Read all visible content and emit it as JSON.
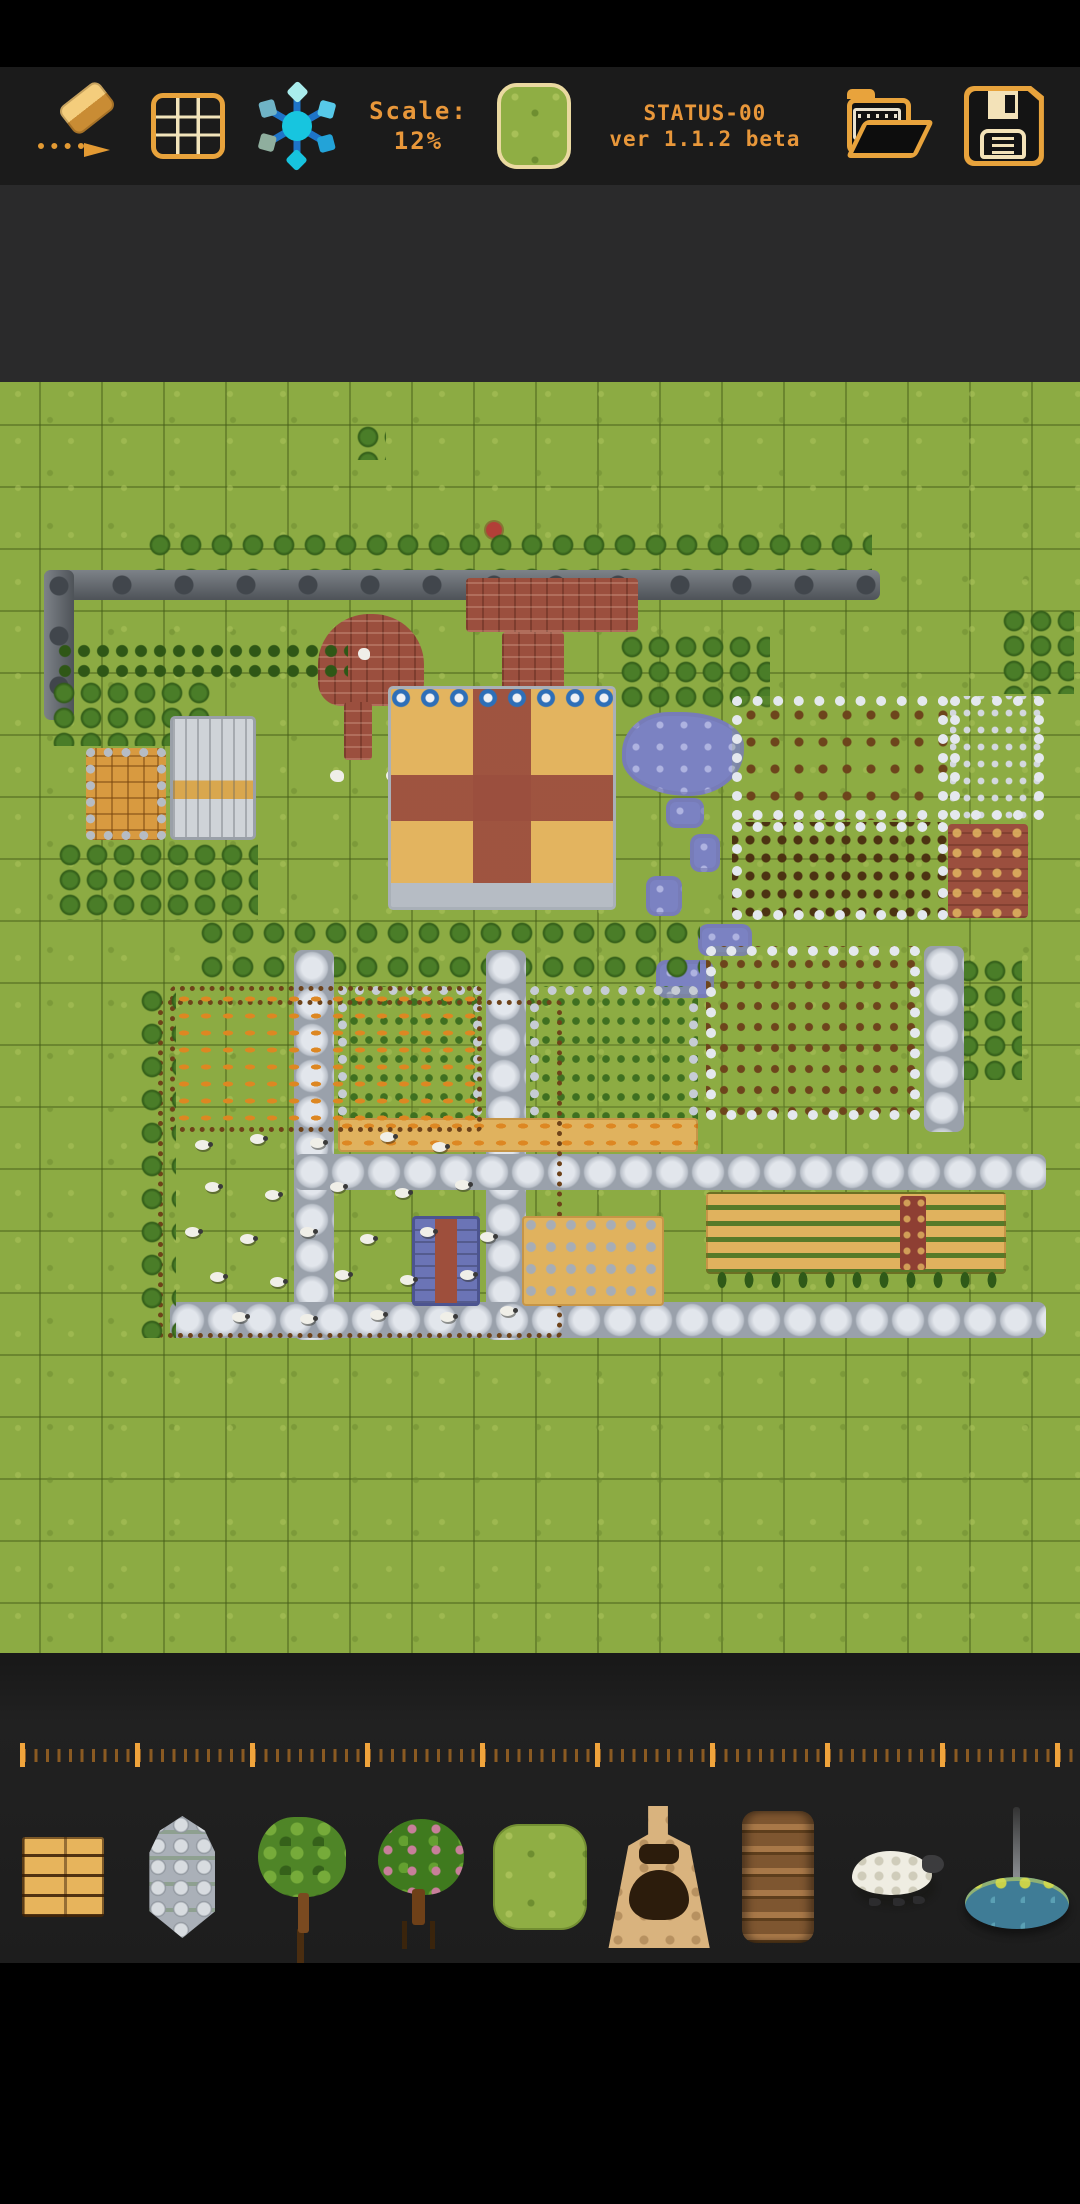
{
  "app": {
    "status_line": "STATUS-00",
    "version_line": "ver 1.1.2 beta",
    "scale_label": "Scale:",
    "scale_value": "12%"
  },
  "colors": {
    "accent_orange": "#e8a33c",
    "text_orange": "#e8973a",
    "toolbar_bg": "#1b1b1b",
    "workspace_bg": "#2a2a2b",
    "grass": "#8cab43",
    "stone_path": "#c9cdd5",
    "brick": "#9b4f3e",
    "pond": "#7b82c2",
    "sand": "#e0b25e"
  },
  "toolbar": {
    "icons": [
      "eraser-icon",
      "grid-icon",
      "snowflake-icon",
      "current-tile-grass",
      "open-folder-icon",
      "save-icon"
    ]
  },
  "ruler": {
    "minor_tick_spacing_px": 11.5,
    "minor_per_major": 10,
    "tick_color_major": "#f0a43c",
    "tick_color_minor": "#8a5a22"
  },
  "palette": {
    "items": [
      {
        "id": "wood",
        "label": "wood-planks-tile"
      },
      {
        "id": "stone",
        "label": "stone-pillar-tile"
      },
      {
        "id": "tree",
        "label": "tree-tile"
      },
      {
        "id": "fruit",
        "label": "fruit-tree-tile"
      },
      {
        "id": "grass",
        "label": "grass-tile",
        "selected": true
      },
      {
        "id": "kiln",
        "label": "kiln-tile"
      },
      {
        "id": "barrels",
        "label": "barrel-stack-tile"
      },
      {
        "id": "sheep",
        "label": "sheep-tile"
      },
      {
        "id": "fountain",
        "label": "fountain-tile"
      }
    ]
  },
  "map": {
    "cell_px": 62,
    "features": [
      {
        "name": "lone-tree",
        "type": "tree-cluster",
        "x": 356,
        "y": 44,
        "w": 30,
        "h": 34
      },
      {
        "name": "red-flower",
        "type": "flower",
        "x": 486,
        "y": 140,
        "w": 16,
        "h": 16
      },
      {
        "name": "wall-tree-row",
        "type": "tree-row",
        "x": 148,
        "y": 152,
        "w": 724,
        "h": 36
      },
      {
        "name": "north-wall",
        "type": "wall",
        "x": 44,
        "y": 188,
        "w": 836,
        "h": 30
      },
      {
        "name": "west-wall",
        "type": "wall-v",
        "x": 44,
        "y": 188,
        "w": 30,
        "h": 150
      },
      {
        "name": "brick-gate",
        "type": "brick",
        "x": 466,
        "y": 196,
        "w": 172,
        "h": 54
      },
      {
        "name": "brick-chimney-path",
        "type": "brick",
        "x": 502,
        "y": 250,
        "w": 62,
        "h": 278
      },
      {
        "name": "brick-heart",
        "type": "brick-heart",
        "x": 318,
        "y": 232,
        "w": 106,
        "h": 92
      },
      {
        "name": "brick-trail",
        "type": "brick",
        "x": 344,
        "y": 320,
        "w": 28,
        "h": 58
      },
      {
        "name": "dove-1",
        "type": "bird",
        "x": 330,
        "y": 388,
        "w": 14,
        "h": 12
      },
      {
        "name": "dove-2",
        "type": "bird",
        "x": 386,
        "y": 388,
        "w": 14,
        "h": 12
      },
      {
        "name": "dove-3",
        "type": "bird",
        "x": 358,
        "y": 266,
        "w": 12,
        "h": 12
      },
      {
        "name": "hedge-row",
        "type": "hedge",
        "x": 56,
        "y": 260,
        "w": 292,
        "h": 42
      },
      {
        "name": "left-grove",
        "type": "tree-cluster",
        "x": 52,
        "y": 300,
        "w": 160,
        "h": 64
      },
      {
        "name": "stone-house",
        "type": "house-stone",
        "x": 86,
        "y": 366,
        "w": 80,
        "h": 92
      },
      {
        "name": "gable-house",
        "type": "house-gable",
        "x": 170,
        "y": 334,
        "w": 86,
        "h": 124
      },
      {
        "name": "south-grove-left",
        "type": "tree-cluster",
        "x": 58,
        "y": 462,
        "w": 200,
        "h": 76
      },
      {
        "name": "manor-grove-east",
        "type": "tree-cluster",
        "x": 620,
        "y": 254,
        "w": 150,
        "h": 72
      },
      {
        "name": "ne-grove",
        "type": "tree-cluster",
        "x": 1002,
        "y": 228,
        "w": 72,
        "h": 84
      },
      {
        "name": "manor",
        "type": "manor",
        "x": 388,
        "y": 304,
        "w": 228,
        "h": 224
      },
      {
        "name": "pond",
        "type": "pond",
        "x": 622,
        "y": 330,
        "w": 122,
        "h": 84
      },
      {
        "name": "stream-1",
        "type": "water",
        "x": 666,
        "y": 416,
        "w": 38,
        "h": 30
      },
      {
        "name": "stream-2",
        "type": "water",
        "x": 690,
        "y": 452,
        "w": 30,
        "h": 38
      },
      {
        "name": "stream-3",
        "type": "water",
        "x": 646,
        "y": 494,
        "w": 36,
        "h": 40
      },
      {
        "name": "stream-4",
        "type": "water",
        "x": 698,
        "y": 542,
        "w": 54,
        "h": 32
      },
      {
        "name": "stream-5",
        "type": "water",
        "x": 656,
        "y": 578,
        "w": 58,
        "h": 38
      },
      {
        "name": "ne-field-hay",
        "type": "field-white crops-brown-sparse",
        "x": 732,
        "y": 314,
        "w": 216,
        "h": 124
      },
      {
        "name": "ne-field-stones",
        "type": "field-white crops-gray",
        "x": 950,
        "y": 314,
        "w": 94,
        "h": 124
      },
      {
        "name": "e-field-bushes",
        "type": "field-white crops-darkbrown",
        "x": 732,
        "y": 440,
        "w": 216,
        "h": 98
      },
      {
        "name": "e-brick-patch",
        "type": "brick-patch",
        "x": 948,
        "y": 442,
        "w": 80,
        "h": 94
      },
      {
        "name": "e-grove",
        "type": "tree-cluster",
        "x": 956,
        "y": 578,
        "w": 66,
        "h": 120
      },
      {
        "name": "mid-tree-band",
        "type": "tree-row",
        "x": 200,
        "y": 540,
        "w": 500,
        "h": 60
      },
      {
        "name": "path-west",
        "type": "stone-path",
        "x": 294,
        "y": 568,
        "w": 40,
        "h": 390
      },
      {
        "name": "path-mid",
        "type": "stone-path",
        "x": 486,
        "y": 568,
        "w": 40,
        "h": 390
      },
      {
        "name": "path-east",
        "type": "stone-path",
        "x": 924,
        "y": 564,
        "w": 40,
        "h": 186
      },
      {
        "name": "path-cross",
        "type": "stone-path",
        "x": 294,
        "y": 772,
        "w": 752,
        "h": 36
      },
      {
        "name": "path-south",
        "type": "stone-path",
        "x": 170,
        "y": 920,
        "w": 876,
        "h": 36
      },
      {
        "name": "field-a",
        "type": "field-pebble crops-green",
        "x": 338,
        "y": 604,
        "w": 144,
        "h": 164
      },
      {
        "name": "field-b",
        "type": "field-pebble crops-green",
        "x": 530,
        "y": 604,
        "w": 168,
        "h": 164
      },
      {
        "name": "orchard-field",
        "type": "field-white crops-brown",
        "x": 706,
        "y": 564,
        "w": 214,
        "h": 174
      },
      {
        "name": "sand-strip",
        "type": "sand crops-orange",
        "x": 338,
        "y": 736,
        "w": 360,
        "h": 34
      },
      {
        "name": "sand-field",
        "type": "sand crops-greenrows",
        "x": 706,
        "y": 810,
        "w": 300,
        "h": 82
      },
      {
        "name": "sand-field-red",
        "type": "redstrip",
        "x": 900,
        "y": 814,
        "w": 26,
        "h": 74
      },
      {
        "name": "cypress-row",
        "type": "cypress",
        "x": 710,
        "y": 884,
        "w": 292,
        "h": 30
      },
      {
        "name": "pasture",
        "type": "wood-fence",
        "x": 158,
        "y": 618,
        "w": 404,
        "h": 338
      },
      {
        "name": "pasture-crops",
        "type": "wood-fence crops-orange",
        "x": 170,
        "y": 604,
        "w": 312,
        "h": 146
      },
      {
        "name": "west-tree-column",
        "type": "tree-column",
        "x": 140,
        "y": 608,
        "w": 36,
        "h": 348
      },
      {
        "name": "blue-house",
        "type": "blue-house",
        "x": 412,
        "y": 834,
        "w": 68,
        "h": 90
      },
      {
        "name": "kiln-yard",
        "type": "sand crops-graydots",
        "x": 522,
        "y": 834,
        "w": 142,
        "h": 90
      }
    ],
    "sheep": [
      [
        195,
        758
      ],
      [
        250,
        752
      ],
      [
        310,
        756
      ],
      [
        380,
        750
      ],
      [
        432,
        760
      ],
      [
        205,
        800
      ],
      [
        265,
        808
      ],
      [
        330,
        800
      ],
      [
        395,
        806
      ],
      [
        455,
        798
      ],
      [
        185,
        845
      ],
      [
        240,
        852
      ],
      [
        300,
        845
      ],
      [
        360,
        852
      ],
      [
        420,
        845
      ],
      [
        480,
        850
      ],
      [
        210,
        890
      ],
      [
        270,
        895
      ],
      [
        335,
        888
      ],
      [
        400,
        893
      ],
      [
        460,
        888
      ],
      [
        232,
        930
      ],
      [
        300,
        932
      ],
      [
        370,
        928
      ],
      [
        440,
        930
      ],
      [
        500,
        924
      ]
    ]
  }
}
